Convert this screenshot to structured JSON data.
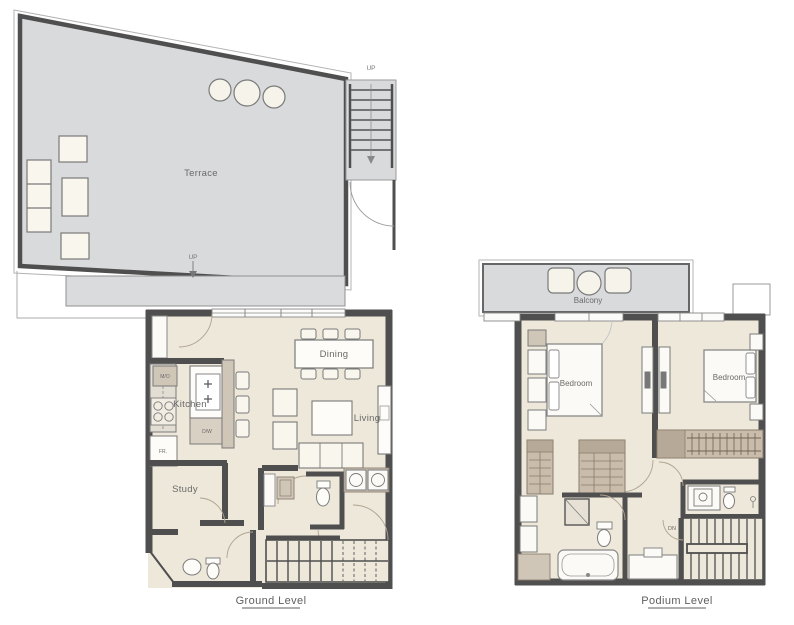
{
  "ground_level": {
    "caption": "Ground Level",
    "rooms": {
      "terrace": "Terrace",
      "kitchen": "Kitchen",
      "dining": "Dining",
      "living": "Living",
      "study": "Study"
    },
    "appliances": {
      "microwave_oven": "M/O",
      "dishwasher": "D/W",
      "fridge": "FR."
    },
    "stairs_up_label": "UP",
    "terrace_exit_label": "UP"
  },
  "podium_level": {
    "caption": "Podium Level",
    "rooms": {
      "balcony": "Balcony",
      "bedroom_left": "Bedroom",
      "bedroom_right": "Bedroom"
    },
    "stairs_down_label": "DN"
  },
  "colors": {
    "interior_floor": "#ede8da",
    "terrace_floor": "#d9dadc",
    "wall": "#4f4f4f",
    "furniture": "#f9f6ee",
    "wardrobe": "#c9bcab",
    "wardrobe_dark": "#b7a997",
    "counter": "#cfc6b8",
    "label_text": "#6a6a6a"
  }
}
